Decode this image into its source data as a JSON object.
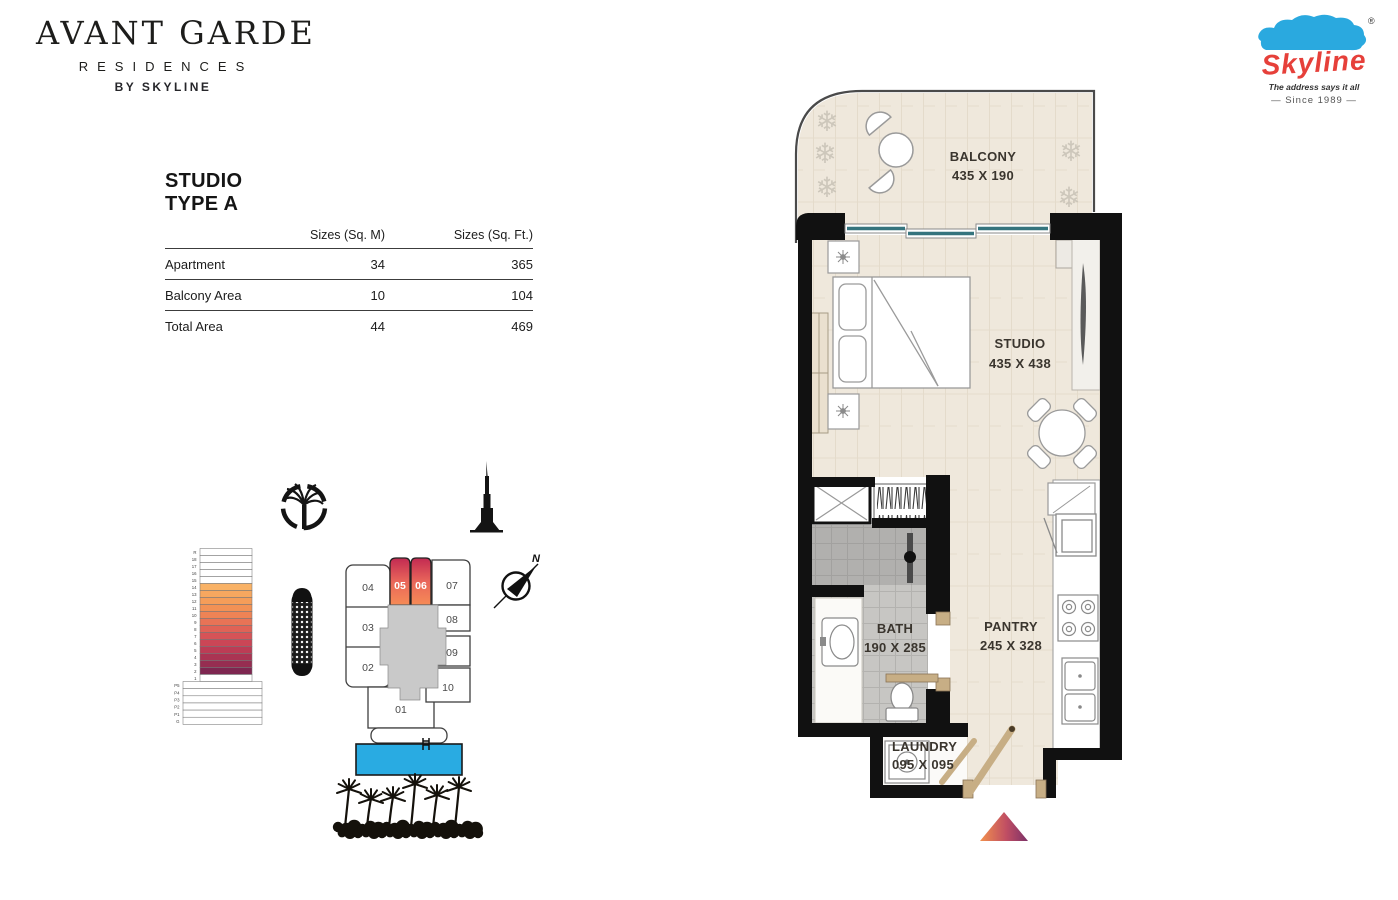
{
  "brand": {
    "line1": "AVANT GARDE",
    "line2": "RESIDENCES",
    "line3": "BY SKYLINE"
  },
  "skyline_logo": {
    "name": "Skyline",
    "reg": "®",
    "tagline": "The address says it all",
    "since": "—   Since 1989   —",
    "red": "#E6403A",
    "blue": "#2AA9DF"
  },
  "unit_info": {
    "name": "STUDIO",
    "type": "TYPE A"
  },
  "area_table": {
    "col_sqm": "Sizes (Sq. M)",
    "col_sqft": "Sizes (Sq. Ft.)",
    "rows": [
      {
        "label": "Apartment",
        "sqm": "34",
        "sqft": "365"
      },
      {
        "label": "Balcony Area",
        "sqm": "10",
        "sqft": "104"
      },
      {
        "label": "Total Area",
        "sqm": "44",
        "sqft": "469"
      }
    ]
  },
  "plan": {
    "rooms": [
      {
        "name": "BALCONY",
        "dims": "435 X 190"
      },
      {
        "name": "STUDIO",
        "dims": "435 X 438"
      },
      {
        "name": "BATH",
        "dims": "190 X 285"
      },
      {
        "name": "PANTRY",
        "dims": "245 X 328"
      },
      {
        "name": "LAUNDRY",
        "dims": "095 X 095"
      }
    ]
  },
  "key_plan": {
    "units": [
      "01",
      "02",
      "03",
      "04",
      "05",
      "06",
      "07",
      "08",
      "09",
      "10"
    ],
    "highlighted": [
      "05",
      "06"
    ]
  },
  "floor_stack": {
    "tower_floors": [
      "R",
      "18",
      "17",
      "16",
      "15",
      "14",
      "13",
      "12",
      "11",
      "10",
      "9",
      "8",
      "7",
      "6",
      "5",
      "4",
      "3",
      "2",
      "1"
    ],
    "podium_floors": [
      "P5",
      "P4",
      "P3",
      "P2",
      "P1",
      "G"
    ],
    "floor_colors": {
      "14": "#F9B266",
      "13": "#F7A75F",
      "12": "#F59D59",
      "11": "#F29155",
      "10": "#EE8355",
      "9": "#E87356",
      "8": "#E06256",
      "7": "#D65357",
      "6": "#CB4656",
      "5": "#BC3C55",
      "4": "#AA3453",
      "3": "#962D51",
      "2": "#7E2650"
    }
  },
  "compass": {
    "north": "N"
  },
  "icons": {
    "plant": "❄"
  },
  "colors": {
    "wall": "#111111",
    "floor": "#EFE8DC",
    "window": "#35747E",
    "pool": "#29ABE2",
    "unit_gradient": [
      "#C22A52",
      "#E9665A",
      "#F68B56"
    ],
    "entry_marker": [
      "#F2914D",
      "#C04E63",
      "#7C3168"
    ]
  }
}
